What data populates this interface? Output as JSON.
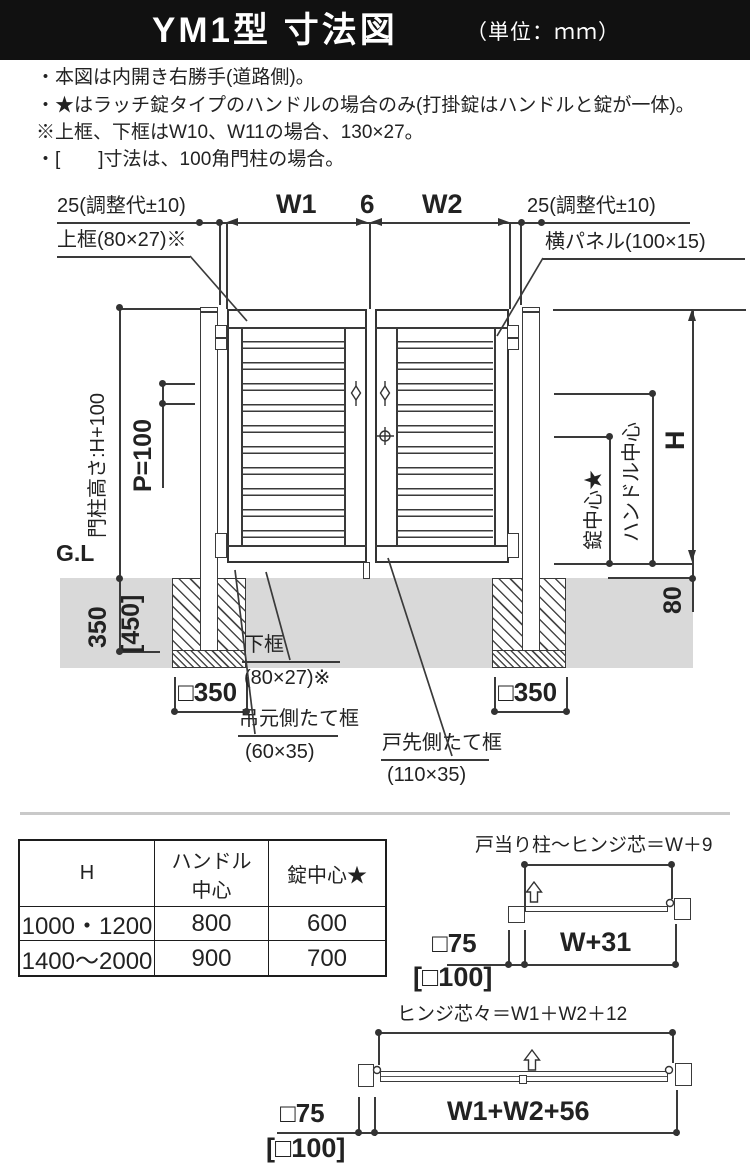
{
  "header": {
    "title": "YM1型 寸法図",
    "unit": "（単位：ｍｍ）"
  },
  "notes": {
    "lines": [
      "・本図は内開き右勝手(道路側)。",
      "・★はラッチ錠タイプのハンドルの場合のみ(打掛錠はハンドルと錠が一体)。",
      "※上框、下框はW10、W11の場合、130×27。",
      "・[　　]寸法は、100角門柱の場合。"
    ]
  },
  "diagram": {
    "top_dims": {
      "left_adjust": "25(調整代±10)",
      "w1": "W1",
      "gap": "6",
      "w2": "W2",
      "right_adjust": "25(調整代±10)"
    },
    "part_labels": {
      "top_rail": "上框(80×27)※",
      "panel": "横パネル(100×15)",
      "bottom_rail": "下框",
      "bottom_rail_size": "(80×27)※",
      "hinge_stile": "吊元側たて框",
      "hinge_stile_size": "(60×35)",
      "latch_stile": "戸先側たて框",
      "latch_stile_size": "(110×35)"
    },
    "left_dims": {
      "post_height": "門柱高さ:H+100",
      "pitch": "P=100",
      "ground": "G.L",
      "embed": "350",
      "embed_alt": "[450]",
      "footing_left": "□350",
      "footing_right": "□350"
    },
    "right_dims": {
      "lock_center": "錠中心★",
      "handle_center": "ハンドル中心",
      "height": "H",
      "bottom_gap": "80"
    }
  },
  "table": {
    "headers": [
      "H",
      "ハンドル中心",
      "錠中心★"
    ],
    "rows": [
      [
        "1000・1200",
        "800",
        "600"
      ],
      [
        "1400〜2000",
        "900",
        "700"
      ]
    ]
  },
  "plan_w": {
    "title": "戸当り柱〜ヒンジ芯＝W＋9",
    "post": "□75",
    "width": "W+31",
    "post_alt": "[□100]"
  },
  "plan_w1w2": {
    "title": "ヒンジ芯々＝W1＋W2＋12",
    "post": "□75",
    "width": "W1+W2+56",
    "post_alt": "[□100]"
  },
  "colors": {
    "line": "#3a3a3a",
    "ground": "#d9d9d9",
    "header_bg": "#111111",
    "divider": "#c9c9c9"
  }
}
